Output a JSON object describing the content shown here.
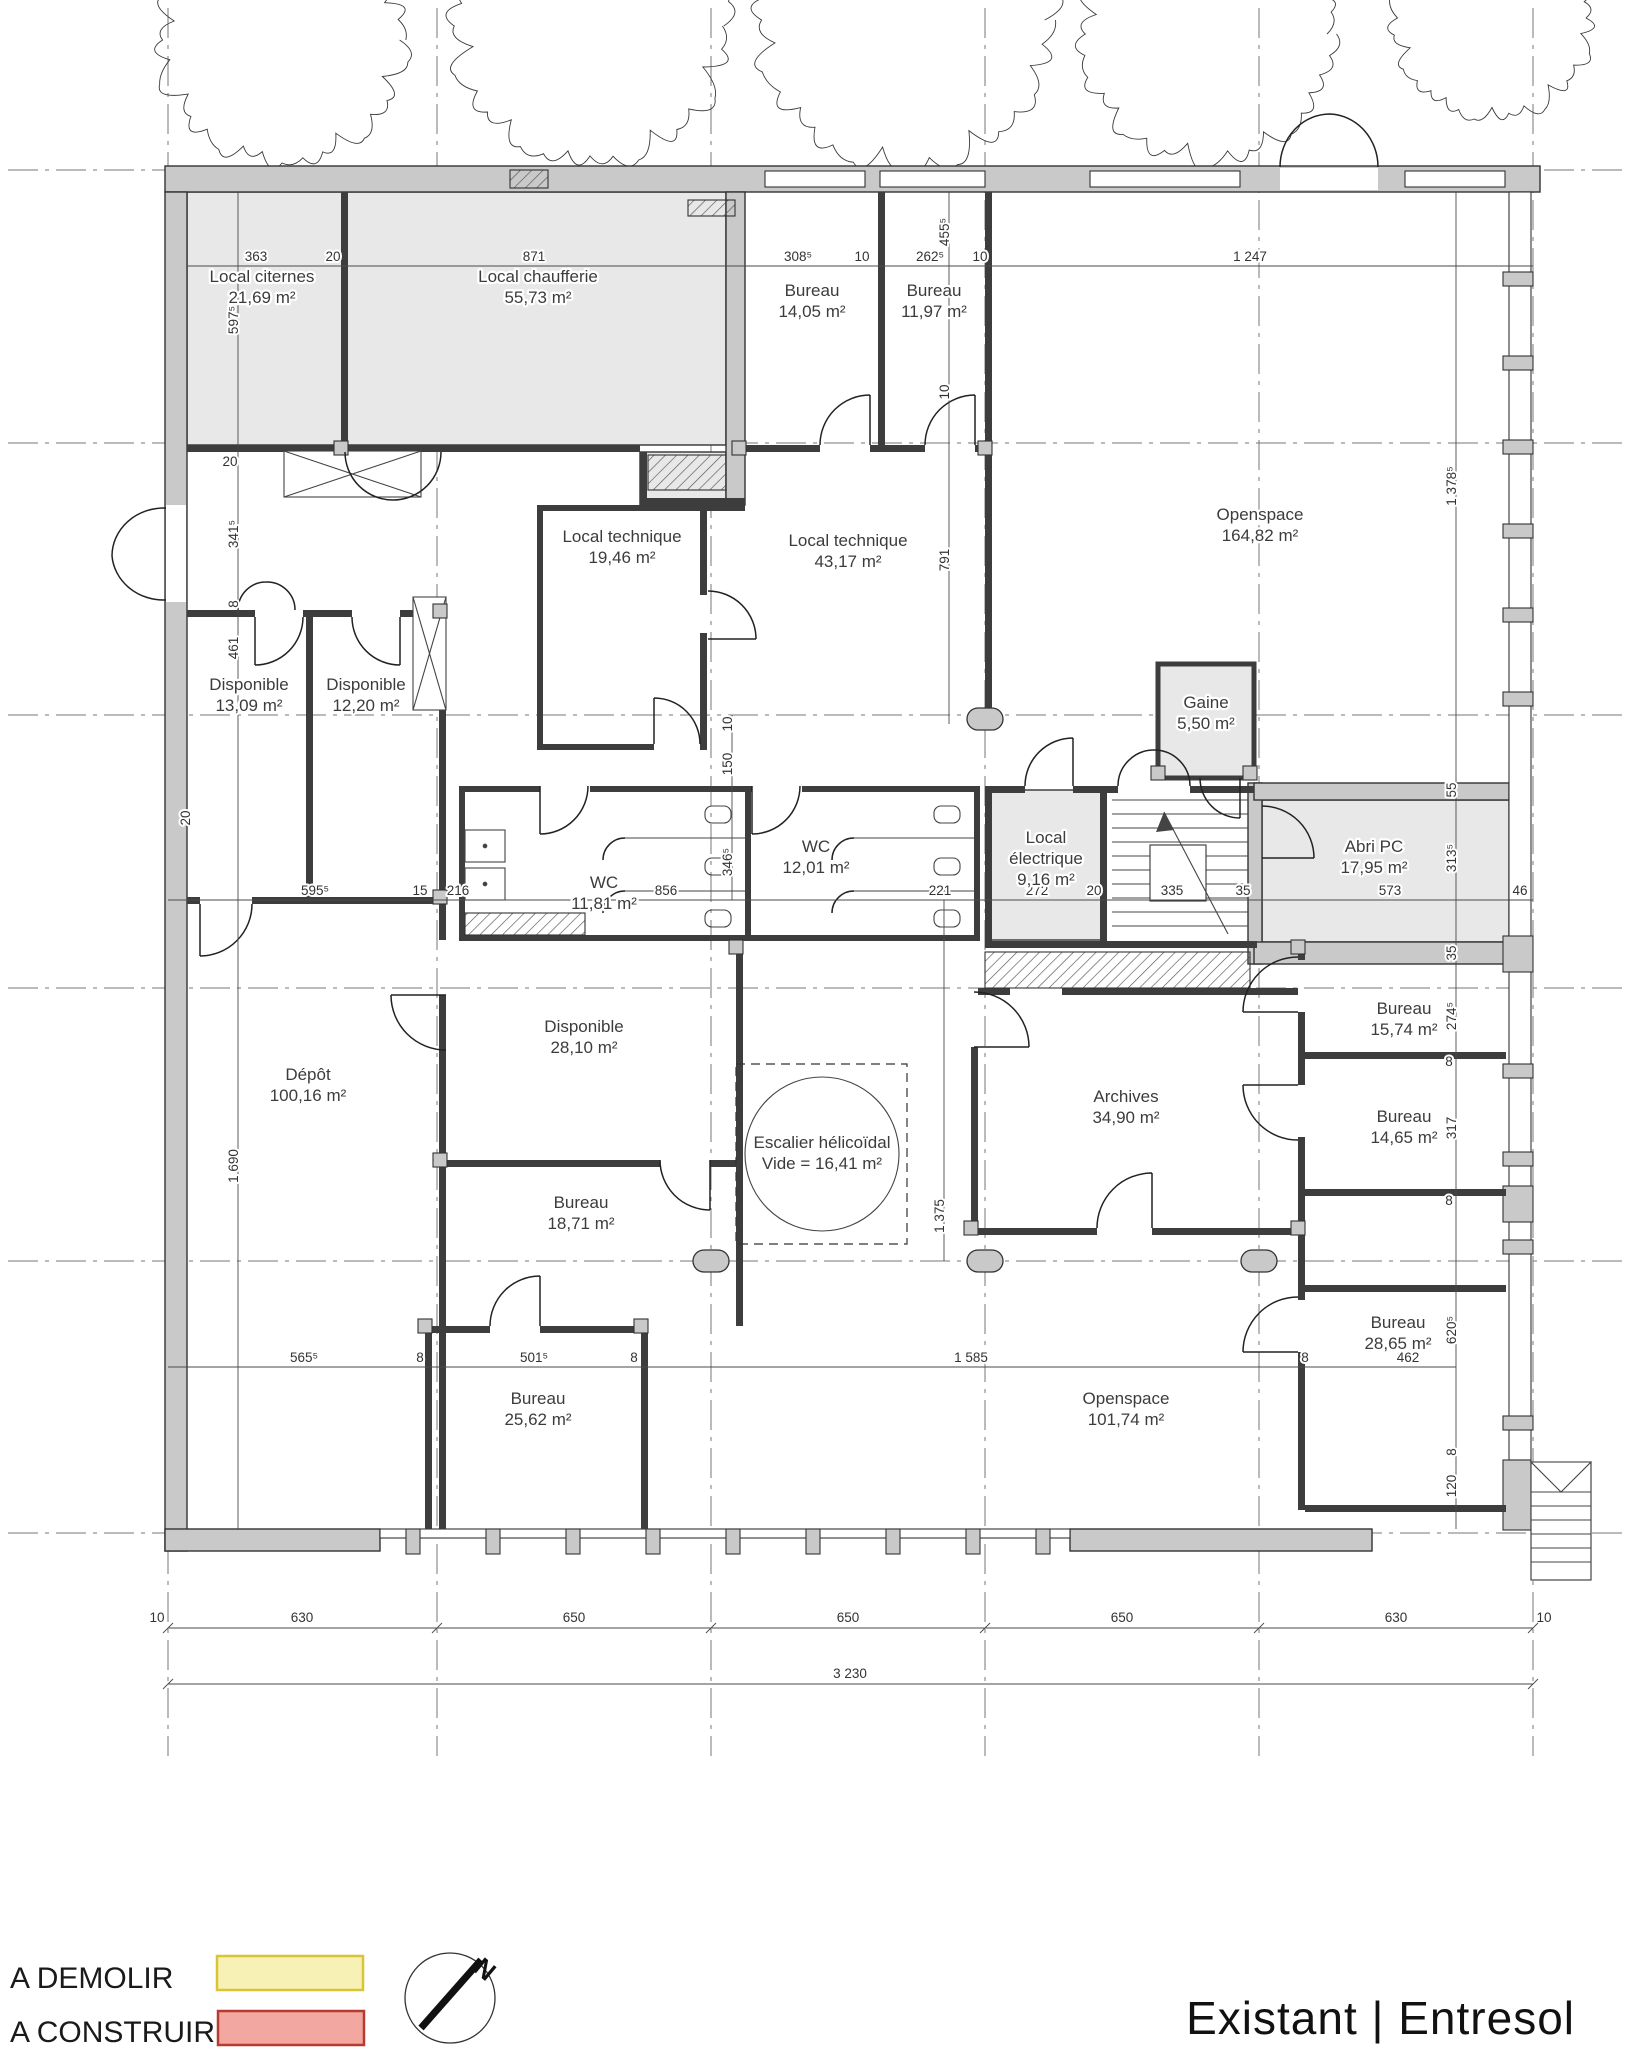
{
  "title": "Existant | Entresol",
  "legend": {
    "demolish_label": "A DEMOLIR",
    "demolish_color": "#f8f1b6",
    "demolish_border": "#d9c437",
    "build_label": "A CONSTRUIRE",
    "build_color": "#f2a7a1",
    "build_border": "#b73b2e",
    "north_label": "N"
  },
  "grid": {
    "x": [
      168,
      437,
      711,
      985,
      1259,
      1533
    ],
    "y": [
      170,
      443,
      715,
      988,
      1261,
      1533
    ]
  },
  "rooms": [
    {
      "lines": [
        "Local citernes",
        "21,69 m²"
      ],
      "x": 262,
      "y": 282
    },
    {
      "lines": [
        "Local chaufferie",
        "55,73 m²"
      ],
      "x": 538,
      "y": 282
    },
    {
      "lines": [
        "Bureau",
        "14,05 m²"
      ],
      "x": 812,
      "y": 296
    },
    {
      "lines": [
        "Bureau",
        "11,97 m²"
      ],
      "x": 934,
      "y": 296
    },
    {
      "lines": [
        "Openspace",
        "164,82 m²"
      ],
      "x": 1260,
      "y": 520
    },
    {
      "lines": [
        "Local technique",
        "19,46 m²"
      ],
      "x": 622,
      "y": 542
    },
    {
      "lines": [
        "Local technique",
        "43,17 m²"
      ],
      "x": 848,
      "y": 546
    },
    {
      "lines": [
        "Disponible",
        "13,09 m²"
      ],
      "x": 249,
      "y": 690
    },
    {
      "lines": [
        "Disponible",
        "12,20 m²"
      ],
      "x": 366,
      "y": 690
    },
    {
      "lines": [
        "Gaine",
        "5,50 m²"
      ],
      "x": 1206,
      "y": 708
    },
    {
      "lines": [
        "Local",
        "électrique",
        "9,16 m²"
      ],
      "x": 1046,
      "y": 843
    },
    {
      "lines": [
        "Abri PC",
        "17,95 m²"
      ],
      "x": 1374,
      "y": 852
    },
    {
      "lines": [
        "WC",
        "11,81 m²"
      ],
      "x": 604,
      "y": 888
    },
    {
      "lines": [
        "WC",
        "12,01 m²"
      ],
      "x": 816,
      "y": 852
    },
    {
      "lines": [
        "Disponible",
        "28,10 m²"
      ],
      "x": 584,
      "y": 1032
    },
    {
      "lines": [
        "Dépôt",
        "100,16 m²"
      ],
      "x": 308,
      "y": 1080
    },
    {
      "lines": [
        "Escalier hélicoïdal",
        "Vide = 16,41 m²"
      ],
      "x": 822,
      "y": 1148
    },
    {
      "lines": [
        "Archives",
        "34,90 m²"
      ],
      "x": 1126,
      "y": 1102
    },
    {
      "lines": [
        "Bureau",
        "18,71 m²"
      ],
      "x": 581,
      "y": 1208
    },
    {
      "lines": [
        "Bureau",
        "15,74 m²"
      ],
      "x": 1404,
      "y": 1014
    },
    {
      "lines": [
        "Bureau",
        "14,65 m²"
      ],
      "x": 1404,
      "y": 1122
    },
    {
      "lines": [
        "Bureau",
        "28,65 m²"
      ],
      "x": 1398,
      "y": 1328
    },
    {
      "lines": [
        "Bureau",
        "25,62 m²"
      ],
      "x": 538,
      "y": 1404
    },
    {
      "lines": [
        "Openspace",
        "101,74 m²"
      ],
      "x": 1126,
      "y": 1404
    }
  ],
  "dimensions": [
    {
      "text": "363",
      "x": 256,
      "y": 261
    },
    {
      "text": "20",
      "x": 333,
      "y": 261
    },
    {
      "text": "871",
      "x": 534,
      "y": 261
    },
    {
      "text": "308⁵",
      "x": 798,
      "y": 261
    },
    {
      "text": "10",
      "x": 862,
      "y": 261
    },
    {
      "text": "262⁵",
      "x": 930,
      "y": 261
    },
    {
      "text": "10",
      "x": 980,
      "y": 261
    },
    {
      "text": "1 247",
      "x": 1250,
      "y": 261
    },
    {
      "text": "597⁵",
      "x": 238,
      "y": 320,
      "rot": true
    },
    {
      "text": "455⁵",
      "x": 949,
      "y": 232,
      "rot": true
    },
    {
      "text": "10",
      "x": 949,
      "y": 392,
      "rot": true
    },
    {
      "text": "791",
      "x": 949,
      "y": 560,
      "rot": true
    },
    {
      "text": "1 378⁵",
      "x": 1456,
      "y": 486,
      "rot": true
    },
    {
      "text": "20",
      "x": 230,
      "y": 466
    },
    {
      "text": "341⁵",
      "x": 238,
      "y": 534,
      "rot": true
    },
    {
      "text": "8",
      "x": 238,
      "y": 604,
      "rot": true
    },
    {
      "text": "461",
      "x": 238,
      "y": 648,
      "rot": true
    },
    {
      "text": "20",
      "x": 190,
      "y": 818,
      "rot": true
    },
    {
      "text": "1 690",
      "x": 238,
      "y": 1166,
      "rot": true
    },
    {
      "text": "10",
      "x": 732,
      "y": 724,
      "rot": true
    },
    {
      "text": "150",
      "x": 732,
      "y": 764,
      "rot": true
    },
    {
      "text": "346⁵",
      "x": 732,
      "y": 862,
      "rot": true
    },
    {
      "text": "595⁵",
      "x": 315,
      "y": 895
    },
    {
      "text": "15",
      "x": 420,
      "y": 895
    },
    {
      "text": "216",
      "x": 458,
      "y": 895
    },
    {
      "text": "856",
      "x": 666,
      "y": 895
    },
    {
      "text": "221",
      "x": 940,
      "y": 895
    },
    {
      "text": "272",
      "x": 1037,
      "y": 895
    },
    {
      "text": "20",
      "x": 1094,
      "y": 895
    },
    {
      "text": "335",
      "x": 1172,
      "y": 895
    },
    {
      "text": "35",
      "x": 1243,
      "y": 895
    },
    {
      "text": "573",
      "x": 1390,
      "y": 895
    },
    {
      "text": "46",
      "x": 1520,
      "y": 895
    },
    {
      "text": "55",
      "x": 1456,
      "y": 790,
      "rot": true
    },
    {
      "text": "313⁵",
      "x": 1456,
      "y": 858,
      "rot": true
    },
    {
      "text": "35",
      "x": 1456,
      "y": 953,
      "rot": true
    },
    {
      "text": "274⁵",
      "x": 1456,
      "y": 1016,
      "rot": true
    },
    {
      "text": "8",
      "x": 1449,
      "y": 1066
    },
    {
      "text": "317",
      "x": 1456,
      "y": 1128,
      "rot": true
    },
    {
      "text": "8",
      "x": 1449,
      "y": 1205
    },
    {
      "text": "620⁵",
      "x": 1456,
      "y": 1330,
      "rot": true
    },
    {
      "text": "8",
      "x": 1456,
      "y": 1452,
      "rot": true
    },
    {
      "text": "120",
      "x": 1456,
      "y": 1486,
      "rot": true
    },
    {
      "text": "1 375",
      "x": 944,
      "y": 1216,
      "rot": true
    },
    {
      "text": "565⁵",
      "x": 304,
      "y": 1362
    },
    {
      "text": "8",
      "x": 420,
      "y": 1362
    },
    {
      "text": "501⁵",
      "x": 534,
      "y": 1362
    },
    {
      "text": "8",
      "x": 634,
      "y": 1362
    },
    {
      "text": "1 585",
      "x": 971,
      "y": 1362
    },
    {
      "text": "8",
      "x": 1305,
      "y": 1362
    },
    {
      "text": "462",
      "x": 1408,
      "y": 1362
    },
    {
      "text": "10",
      "x": 157,
      "y": 1622
    },
    {
      "text": "630",
      "x": 302,
      "y": 1622
    },
    {
      "text": "650",
      "x": 574,
      "y": 1622
    },
    {
      "text": "650",
      "x": 848,
      "y": 1622
    },
    {
      "text": "650",
      "x": 1122,
      "y": 1622
    },
    {
      "text": "630",
      "x": 1396,
      "y": 1622
    },
    {
      "text": "10",
      "x": 1544,
      "y": 1622
    },
    {
      "text": "3 230",
      "x": 850,
      "y": 1678
    }
  ],
  "trees": [
    {
      "x": 282,
      "y": 40,
      "r": 118
    },
    {
      "x": 590,
      "y": 26,
      "r": 132
    },
    {
      "x": 905,
      "y": 20,
      "r": 142
    },
    {
      "x": 1207,
      "y": 34,
      "r": 122
    },
    {
      "x": 1492,
      "y": 18,
      "r": 96
    }
  ]
}
